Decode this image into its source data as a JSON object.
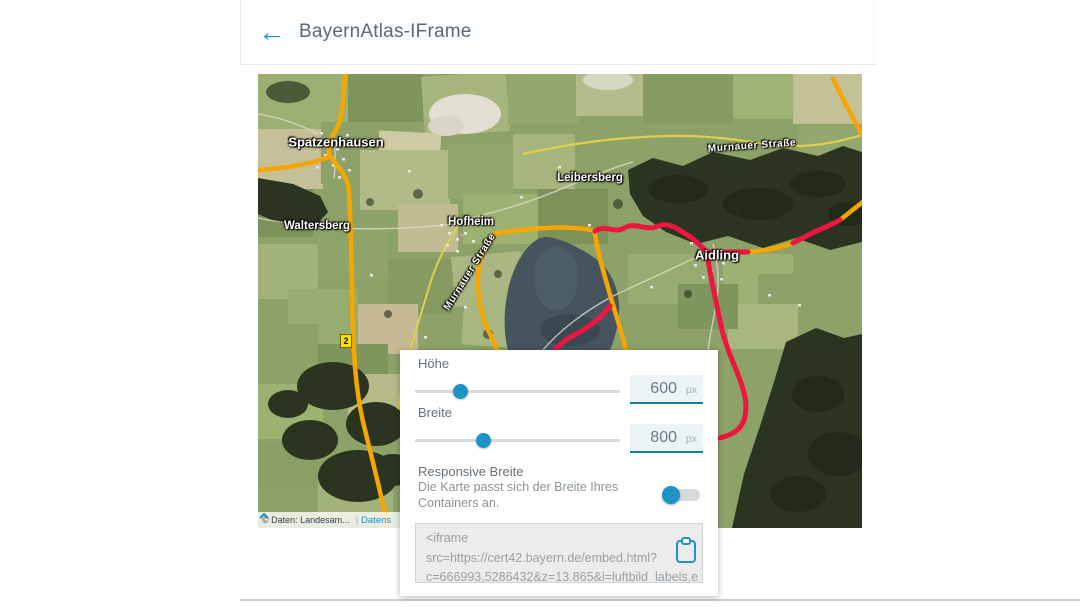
{
  "header": {
    "back_icon": "←",
    "title": "BayernAtlas-IFrame"
  },
  "map": {
    "labels": [
      {
        "id": "spatzenhausen",
        "text": "Spatzenhausen"
      },
      {
        "id": "waltersberg",
        "text": "Waltersberg"
      },
      {
        "id": "hofheim",
        "text": "Hofheim"
      },
      {
        "id": "leibersberg",
        "text": "Leibersberg"
      },
      {
        "id": "aidling",
        "text": "Aidling"
      },
      {
        "id": "murnauer-strasse-top",
        "text": "Murnauer Straße"
      },
      {
        "id": "murnauer-strasse-west",
        "text": "Murnauer Straße"
      }
    ],
    "route_marker_label": "2",
    "attribution": {
      "copyright": "© Daten: Landesam...",
      "separator": "|",
      "link": "Datens"
    }
  },
  "dialog": {
    "height": {
      "label": "Höhe",
      "value": "600",
      "unit": "px"
    },
    "width": {
      "label": "Breite",
      "value": "800",
      "unit": "px"
    },
    "responsive": {
      "label": "Responsive Breite",
      "description": "Die Karte passt sich der Breite Ihres Containers an."
    },
    "embed_code": {
      "line1": "<iframe",
      "line2": "src=https://cert42.bayern.de/embed.html?",
      "line3": "c=666993,5286432&z=13.865&l=luftbild_labels,e"
    }
  },
  "colors": {
    "accent": "#1d93c6",
    "input_underline": "#1a7aa8",
    "route_orange": "#f7a600",
    "route_red": "#ee1640",
    "road_yellow": "#ded04a",
    "lake": "#45545e",
    "forest": "#2a3421"
  }
}
